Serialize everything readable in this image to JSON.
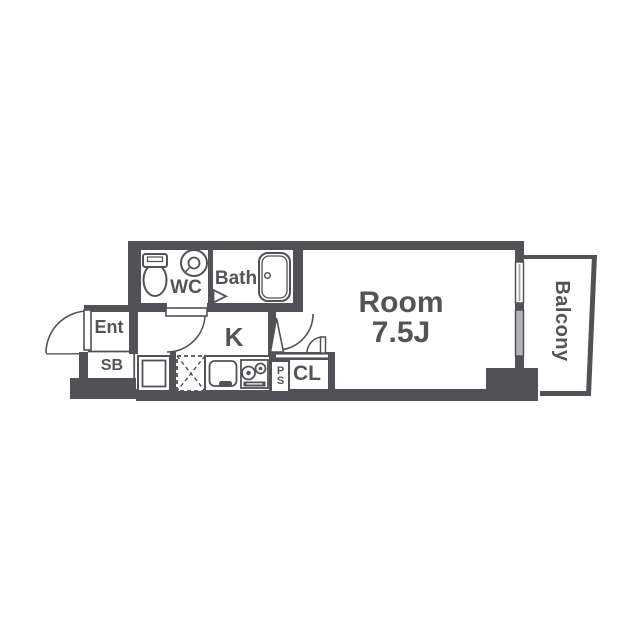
{
  "floorplan": {
    "rooms": {
      "wc": {
        "label": "WC"
      },
      "bath": {
        "label": "Bath"
      },
      "entrance": {
        "label": "Ent"
      },
      "shoe_box": {
        "label": "SB"
      },
      "kitchen": {
        "label": "K"
      },
      "closet": {
        "label": "CL"
      },
      "pipe_space": {
        "label": "PS"
      },
      "main_room": {
        "label": "Room",
        "size": "7.5J"
      },
      "balcony": {
        "label": "Balcony"
      }
    },
    "colors": {
      "wall": "#525256",
      "text": "#545458",
      "window_glass": "#b2b2b6",
      "background": "#ffffff"
    },
    "fixtures": [
      "toilet-icon",
      "hand-basin-icon",
      "bathtub-icon",
      "washing-machine-space-icon",
      "refrigerator-space-icon",
      "kitchen-sink-icon",
      "gas-stove-icon"
    ]
  }
}
